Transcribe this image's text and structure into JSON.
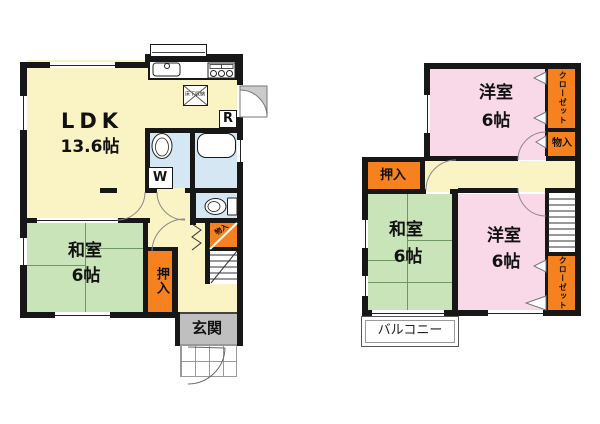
{
  "colors": {
    "room_yellow": "#FAF3C3",
    "tatami_green": "#C9E4B9",
    "western_pink": "#F9D9E7",
    "closet_orange": "#F5821E",
    "wet_area_blue": "#D4E7F3",
    "entry_gray": "#BFBFBF",
    "wall_black": "#171717"
  },
  "floor1": {
    "ldk": {
      "label": "LDK",
      "size": "13.6帖"
    },
    "washitsu": {
      "label": "和室",
      "size": "6帖"
    },
    "oshiire": {
      "label": "押入"
    },
    "genkan": {
      "label": "玄関"
    },
    "understairs_storage": {
      "label": "物入"
    },
    "floor_storage": {
      "label": "床下収納"
    },
    "washer": {
      "label": "W"
    },
    "refrigerator": {
      "label": "R"
    }
  },
  "floor2": {
    "yoshitsu_top": {
      "label": "洋室",
      "size": "6帖"
    },
    "closet_top": {
      "label": "クローゼット"
    },
    "monoire": {
      "label": "物入"
    },
    "oshiire": {
      "label": "押入"
    },
    "washitsu": {
      "label": "和室",
      "size": "6帖"
    },
    "yoshitsu_bottom": {
      "label": "洋室",
      "size": "6帖"
    },
    "closet_bottom": {
      "label": "クローゼット"
    },
    "balcony": {
      "label": "バルコニー"
    }
  }
}
